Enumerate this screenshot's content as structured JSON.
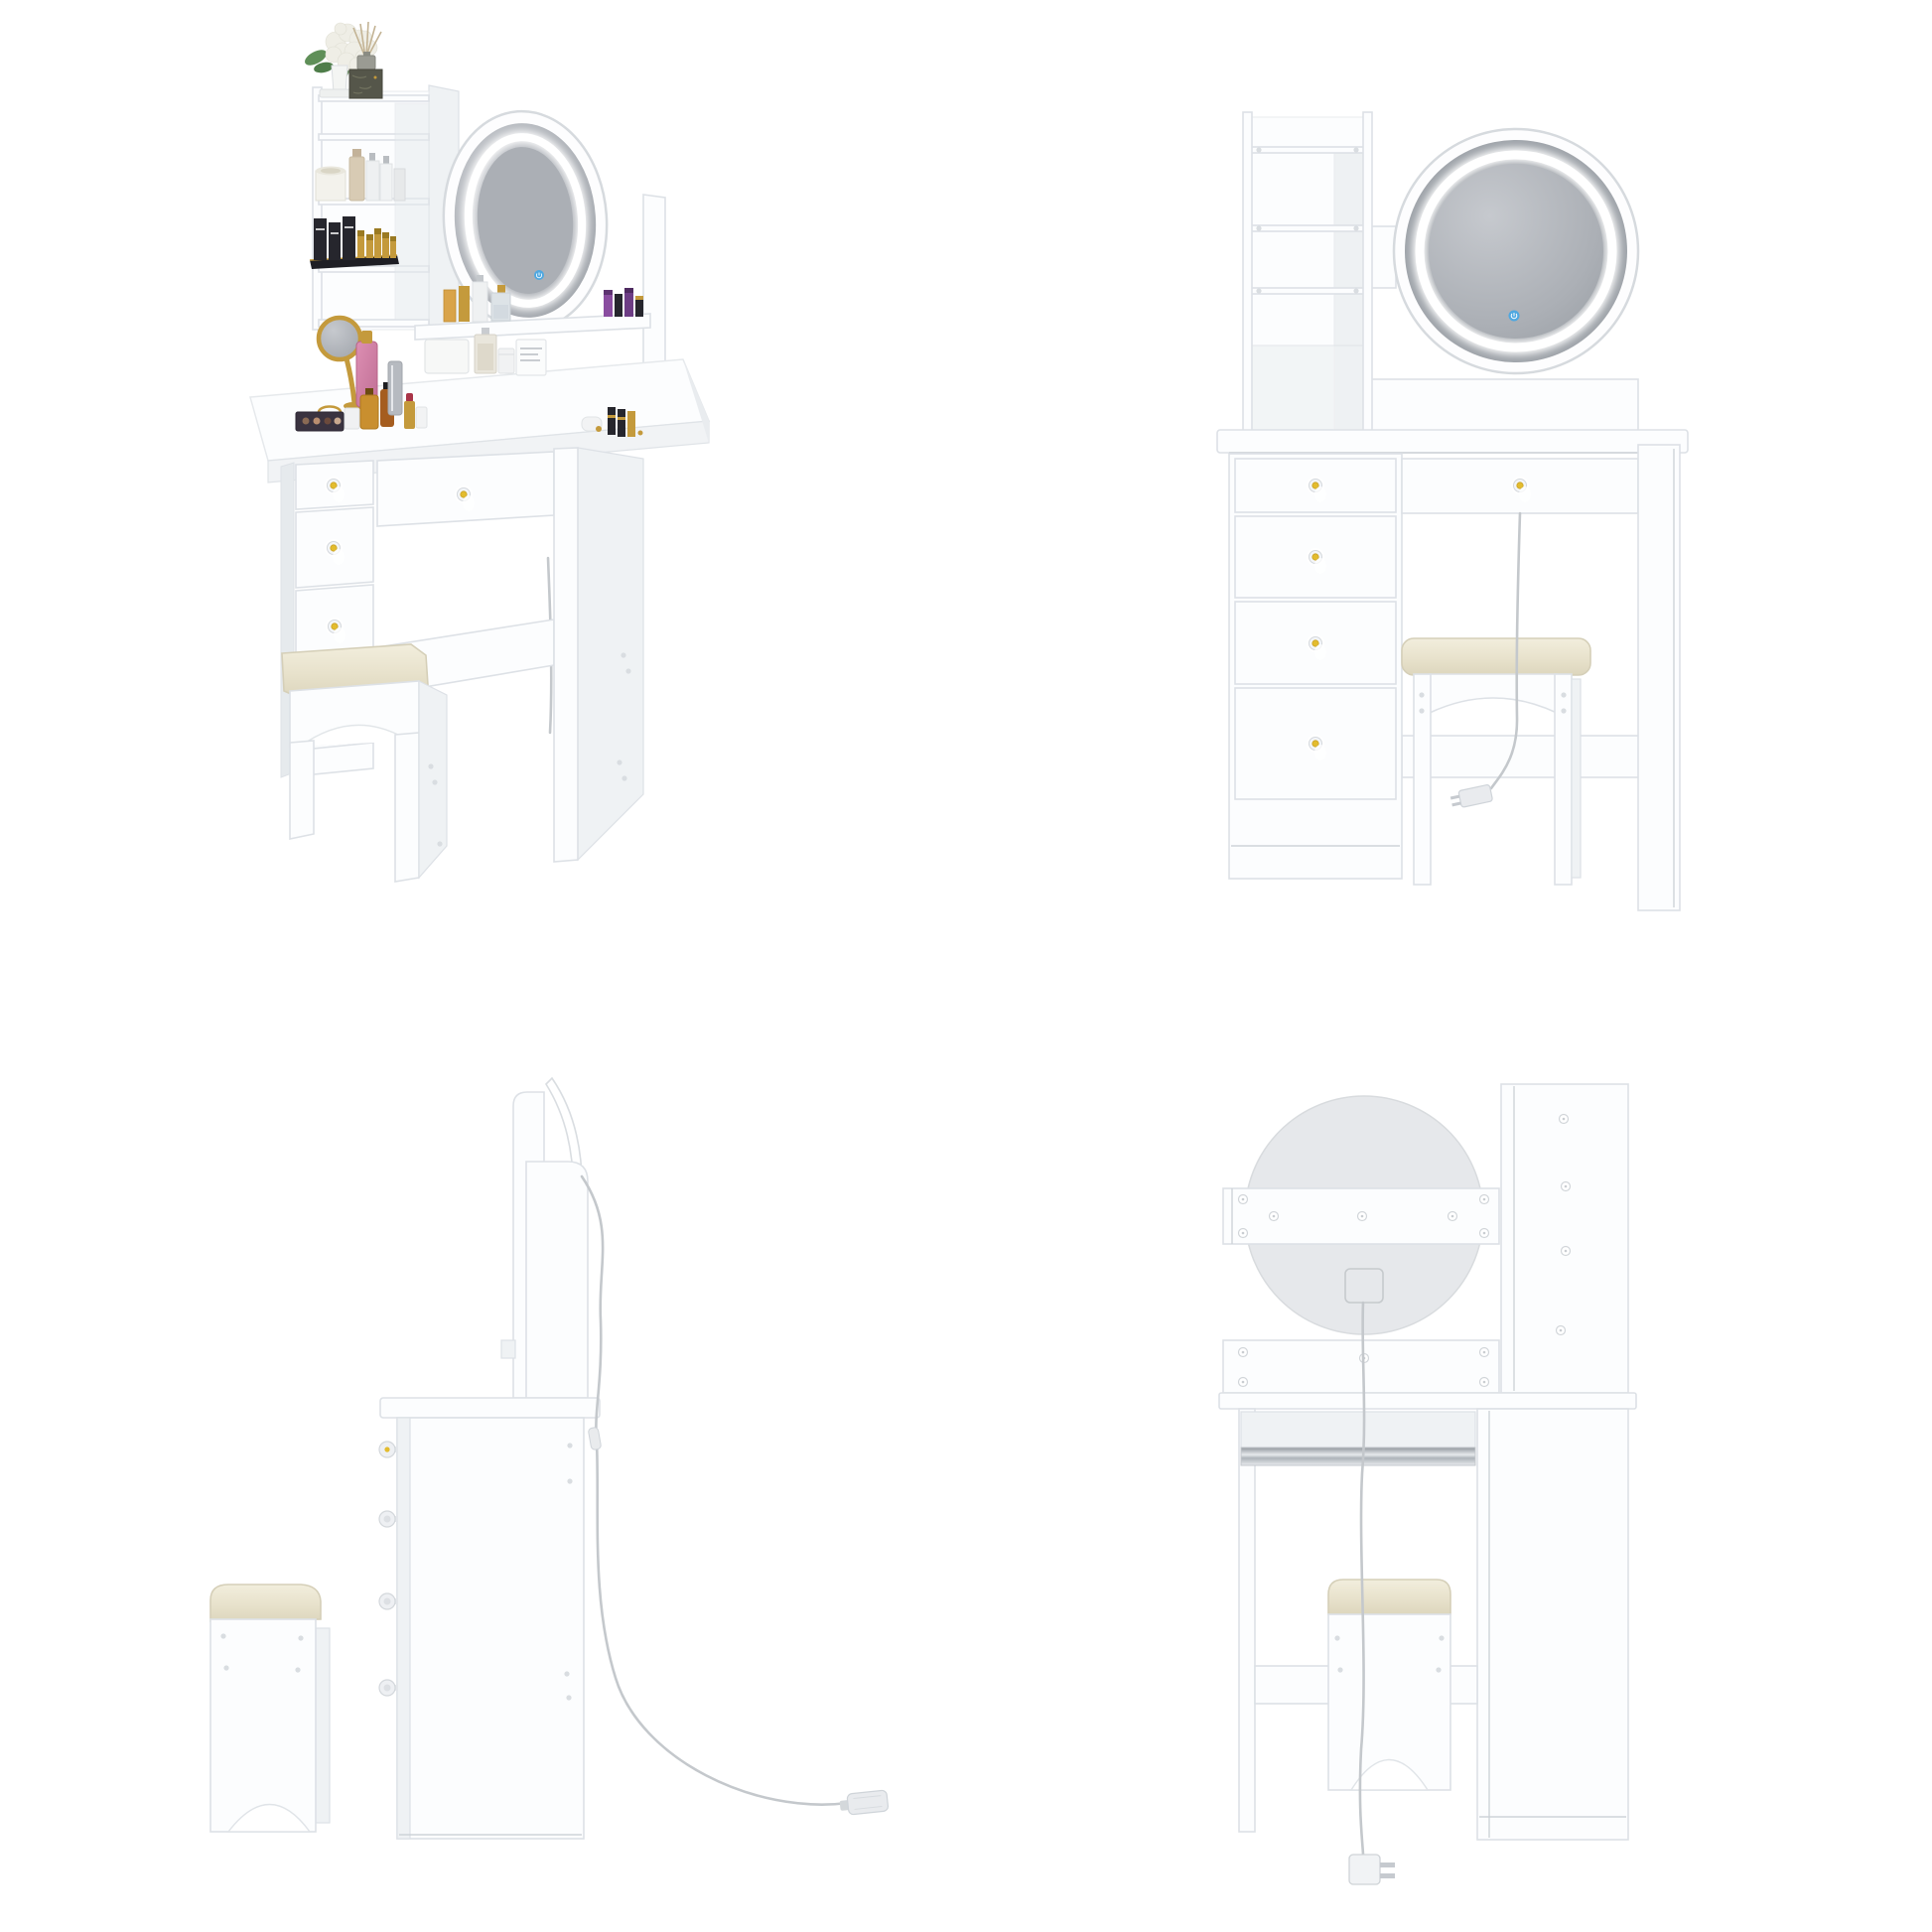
{
  "image_type": "product-gallery",
  "subject": "White vanity dressing table set with round LED touch mirror, storage shelf tower, five gold-knob drawers and cushioned stool, shown in four views",
  "background": "#ffffff",
  "views": [
    {
      "id": "perspective",
      "label": "styled perspective view with cosmetics decor",
      "position": "top-left"
    },
    {
      "id": "front",
      "label": "front view",
      "position": "top-right"
    },
    {
      "id": "side",
      "label": "side view with stool set apart",
      "position": "bottom-left"
    },
    {
      "id": "back",
      "label": "back view",
      "position": "bottom-right"
    }
  ],
  "features": {
    "mirror": {
      "shape": "round",
      "led_ring": true,
      "touch_button": true
    },
    "shelf_tower": {
      "shelf_boards": 4,
      "open_top": true
    },
    "drawers": {
      "left_bank": 4,
      "center_wide": 1,
      "knob_style": "crystal with gold center"
    },
    "stool": {
      "cushion": "cream upholstered",
      "arched_apron": true
    },
    "power": {
      "cord": true,
      "plug": "two-prong",
      "junction_box_on_mirror_back": true
    }
  },
  "decor_items": [
    "hydrangea-flower",
    "reed-diffuser",
    "marble-box",
    "candle",
    "skincare-bottles",
    "perfume-boxes",
    "gold-lipsticks",
    "hand-mirror",
    "pink-perfume",
    "eyeshadow-palette",
    "tissue-box",
    "clear-perfume",
    "cream-jar",
    "nail-polish-vials"
  ],
  "colors": {
    "panel": "#fcfdfe",
    "panel_edge": "#dde1e6",
    "panel_shade": "#eff2f4",
    "panel_deep": "#e6eaed",
    "glass_dark": "#9ba0a6",
    "glass_mid": "#abafb5",
    "glass_light": "#b9bdc3",
    "led": "#ffffff",
    "touch_blue": "#4fa8e0",
    "knob_gold": "#e3bc2e",
    "knob_ring": "#c9a227",
    "cushion_a": "#f2eedd",
    "cushion_b": "#ddd6bd",
    "cushion_edge": "#d5cfb8",
    "cord": "#c4c8cc",
    "mirror_back": "#e6e8eb",
    "metal_a": "#90969c",
    "metal_b": "#e6e9ec",
    "gold": "#c49a3c",
    "gold_dark": "#9a7a22",
    "leaf": "#5f8f58",
    "flower": "#efeee6",
    "marble": "#55564a",
    "pink": "#dd8fb3",
    "pink_deep": "#c06f95",
    "black_item": "#26262d",
    "amber": "#a55d1f",
    "silver": "#b6bac0",
    "beige": "#d8cbb4",
    "red_lip": "#a93448",
    "purple": "#8a4da0"
  }
}
